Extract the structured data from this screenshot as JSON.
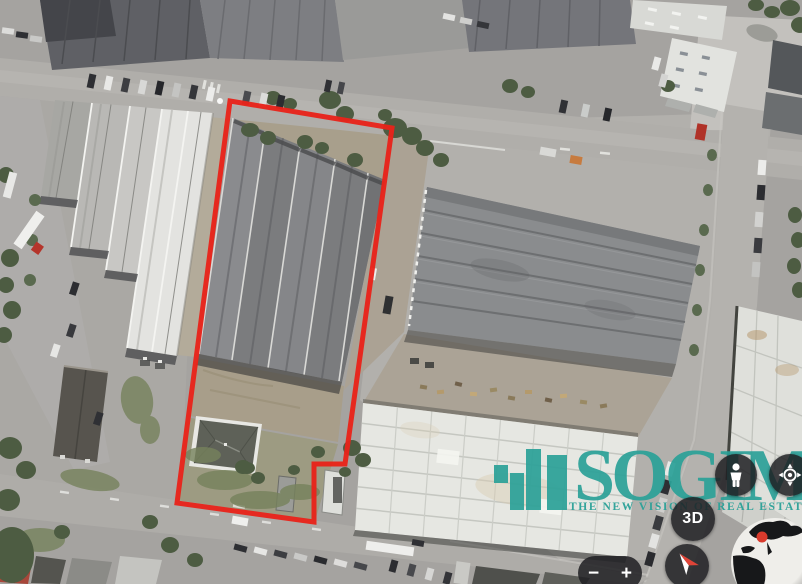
{
  "view": {
    "type": "satellite-aerial-imagery",
    "scene": "industrial-warehouse-district"
  },
  "watermark": {
    "brand": "SOGIM",
    "tagline": "THE NEW VISION OF REAL ESTATE",
    "accent_color": "#2ba198",
    "icon": "sogim-building-bars-logo"
  },
  "boundary": {
    "color": "#e8231a",
    "stroke_px": 5,
    "vertices_px": [
      [
        230,
        101
      ],
      [
        392,
        128
      ],
      [
        345,
        464
      ],
      [
        314,
        464
      ],
      [
        314,
        522
      ],
      [
        177,
        503
      ]
    ]
  },
  "controls": {
    "threed_label": "3D",
    "zoom_out_label": "−",
    "zoom_in_label": "+",
    "pegman_icon": "street-view-pegman",
    "location_icon": "my-location-target",
    "compass_icon": "compass-needle",
    "globe_icon": "earth-globe-overview",
    "globe_marker_color": "#d93a2c"
  }
}
